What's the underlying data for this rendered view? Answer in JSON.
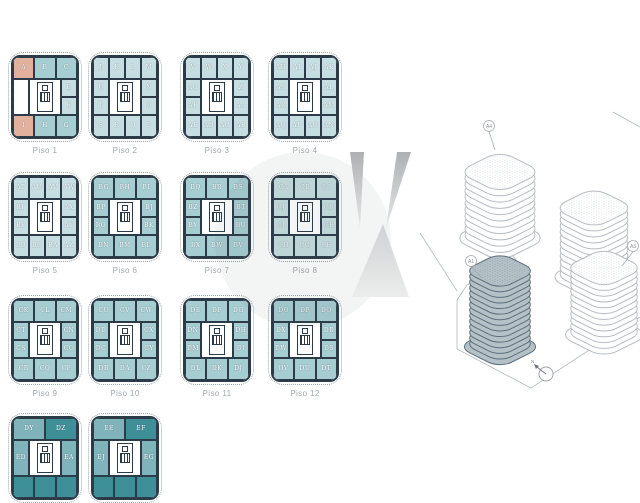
{
  "colors": {
    "white": "#ffffff",
    "salmon": "#e2b19e",
    "pale": "#c6dee1",
    "mid": "#a6cdd2",
    "mid2": "#7fb4bb",
    "dark": "#3e8f98",
    "wall": "#2b3b47",
    "label_gray": "#a0a6ab",
    "site_line": "#b3b8bd",
    "highlight_fill": "#b4c1c7",
    "highlight_stroke": "#5f707b"
  },
  "floors": [
    {
      "label": "Piso 1",
      "top": [
        {
          "t": "A",
          "c": "salmon"
        },
        {
          "t": "B",
          "c": "mid"
        },
        {
          "t": "C",
          "c": "mid"
        }
      ],
      "left": [
        {
          "t": "",
          "c": "white"
        }
      ],
      "right": [
        {
          "t": "E",
          "c": "pale"
        },
        {
          "t": "F",
          "c": "pale"
        }
      ],
      "bottom": [
        {
          "t": "I",
          "c": "salmon"
        },
        {
          "t": "H",
          "c": "mid"
        },
        {
          "t": "G",
          "c": "mid"
        }
      ]
    },
    {
      "label": "Piso 2",
      "top": [
        {
          "t": "J",
          "c": "pale"
        },
        {
          "t": "K",
          "c": "pale"
        },
        {
          "t": "L",
          "c": "pale"
        },
        {
          "t": "M",
          "c": "pale"
        }
      ],
      "left": [
        {
          "t": "U",
          "c": "pale"
        },
        {
          "t": "T",
          "c": "pale"
        }
      ],
      "right": [
        {
          "t": "N",
          "c": "pale"
        },
        {
          "t": "O",
          "c": "pale"
        }
      ],
      "bottom": [
        {
          "t": "S",
          "c": "pale"
        },
        {
          "t": "R",
          "c": "pale"
        },
        {
          "t": "Q",
          "c": "pale"
        },
        {
          "t": "P",
          "c": "pale"
        }
      ]
    },
    {
      "label": "Piso 3",
      "top": [
        {
          "t": "V",
          "c": "pale"
        },
        {
          "t": "W",
          "c": "pale"
        },
        {
          "t": "X",
          "c": "pale"
        },
        {
          "t": "Y",
          "c": "pale"
        }
      ],
      "left": [
        {
          "t": "AG",
          "c": "pale"
        },
        {
          "t": "AF",
          "c": "pale"
        }
      ],
      "right": [
        {
          "t": "Z",
          "c": "pale"
        },
        {
          "t": "AA",
          "c": "pale"
        }
      ],
      "bottom": [
        {
          "t": "AE",
          "c": "pale"
        },
        {
          "t": "AD",
          "c": "pale"
        },
        {
          "t": "AC",
          "c": "pale"
        },
        {
          "t": "AB",
          "c": "pale"
        }
      ]
    },
    {
      "label": "Piso 4",
      "top": [
        {
          "t": "AH",
          "c": "pale"
        },
        {
          "t": "AI",
          "c": "pale"
        },
        {
          "t": "AJ",
          "c": "pale"
        },
        {
          "t": "AK",
          "c": "pale"
        }
      ],
      "left": [
        {
          "t": "AS",
          "c": "pale"
        },
        {
          "t": "AR",
          "c": "pale"
        }
      ],
      "right": [
        {
          "t": "AL",
          "c": "pale"
        },
        {
          "t": "AM",
          "c": "pale"
        }
      ],
      "bottom": [
        {
          "t": "AQ",
          "c": "pale"
        },
        {
          "t": "AP",
          "c": "pale"
        },
        {
          "t": "AO",
          "c": "pale"
        },
        {
          "t": "AN",
          "c": "pale"
        }
      ]
    },
    {
      "label": "Piso 5",
      "top": [
        {
          "t": "AT",
          "c": "pale"
        },
        {
          "t": "AU",
          "c": "pale"
        },
        {
          "t": "AV",
          "c": "pale"
        },
        {
          "t": "AW",
          "c": "pale"
        }
      ],
      "left": [
        {
          "t": "BF",
          "c": "pale"
        },
        {
          "t": "BE",
          "c": "pale"
        }
      ],
      "right": [
        {
          "t": "AX",
          "c": "pale"
        },
        {
          "t": "AY",
          "c": "pale"
        }
      ],
      "bottom": [
        {
          "t": "BD",
          "c": "pale"
        },
        {
          "t": "BC",
          "c": "pale"
        },
        {
          "t": "BA",
          "c": "pale"
        },
        {
          "t": "AZ",
          "c": "pale"
        }
      ]
    },
    {
      "label": "Piso 6",
      "top": [
        {
          "t": "BG",
          "c": "mid"
        },
        {
          "t": "BH",
          "c": "mid"
        },
        {
          "t": "BI",
          "c": "mid"
        }
      ],
      "left": [
        {
          "t": "BP",
          "c": "mid"
        },
        {
          "t": "BO",
          "c": "mid"
        }
      ],
      "right": [
        {
          "t": "BJ",
          "c": "mid"
        },
        {
          "t": "BK",
          "c": "mid"
        }
      ],
      "bottom": [
        {
          "t": "BN",
          "c": "mid"
        },
        {
          "t": "BM",
          "c": "mid"
        },
        {
          "t": "BL",
          "c": "mid"
        }
      ]
    },
    {
      "label": "Piso 7",
      "top": [
        {
          "t": "BQ",
          "c": "mid"
        },
        {
          "t": "BR",
          "c": "mid"
        },
        {
          "t": "BS",
          "c": "mid"
        }
      ],
      "left": [
        {
          "t": "BZ",
          "c": "mid"
        },
        {
          "t": "BY",
          "c": "mid"
        }
      ],
      "right": [
        {
          "t": "BT",
          "c": "mid"
        },
        {
          "t": "BU",
          "c": "mid"
        }
      ],
      "bottom": [
        {
          "t": "BX",
          "c": "mid"
        },
        {
          "t": "BW",
          "c": "mid"
        },
        {
          "t": "BV",
          "c": "mid"
        }
      ]
    },
    {
      "label": "Piso 8",
      "top": [
        {
          "t": "CA",
          "c": "pale"
        },
        {
          "t": "CB",
          "c": "pale"
        },
        {
          "t": "CC",
          "c": "pale"
        }
      ],
      "left": [
        {
          "t": "CJ",
          "c": "pale"
        },
        {
          "t": "CI",
          "c": "pale"
        }
      ],
      "right": [
        {
          "t": "CD",
          "c": "pale"
        },
        {
          "t": "CE",
          "c": "pale"
        }
      ],
      "bottom": [
        {
          "t": "CH",
          "c": "pale"
        },
        {
          "t": "CG",
          "c": "pale"
        },
        {
          "t": "CF",
          "c": "pale"
        }
      ]
    },
    {
      "label": "Piso 9",
      "top": [
        {
          "t": "CK",
          "c": "mid"
        },
        {
          "t": "CL",
          "c": "mid"
        },
        {
          "t": "CM",
          "c": "mid"
        }
      ],
      "left": [
        {
          "t": "CT",
          "c": "mid"
        },
        {
          "t": "CS",
          "c": "mid"
        }
      ],
      "right": [
        {
          "t": "CN",
          "c": "mid"
        },
        {
          "t": "CO",
          "c": "mid"
        }
      ],
      "bottom": [
        {
          "t": "CR",
          "c": "mid"
        },
        {
          "t": "CQ",
          "c": "mid"
        },
        {
          "t": "CP",
          "c": "mid"
        }
      ]
    },
    {
      "label": "Piso 10",
      "top": [
        {
          "t": "CU",
          "c": "mid"
        },
        {
          "t": "CV",
          "c": "mid"
        },
        {
          "t": "CW",
          "c": "mid"
        }
      ],
      "left": [
        {
          "t": "DD",
          "c": "mid"
        },
        {
          "t": "DC",
          "c": "mid"
        }
      ],
      "right": [
        {
          "t": "CX",
          "c": "mid"
        },
        {
          "t": "CY",
          "c": "mid"
        }
      ],
      "bottom": [
        {
          "t": "DB",
          "c": "mid"
        },
        {
          "t": "DA",
          "c": "mid"
        },
        {
          "t": "CZ",
          "c": "mid"
        }
      ]
    },
    {
      "label": "Piso 11",
      "top": [
        {
          "t": "DE",
          "c": "mid"
        },
        {
          "t": "DF",
          "c": "mid"
        },
        {
          "t": "DG",
          "c": "mid"
        }
      ],
      "left": [
        {
          "t": "DN",
          "c": "mid"
        },
        {
          "t": "DM",
          "c": "mid"
        }
      ],
      "right": [
        {
          "t": "DH",
          "c": "mid"
        },
        {
          "t": "DI",
          "c": "mid"
        }
      ],
      "bottom": [
        {
          "t": "DL",
          "c": "mid"
        },
        {
          "t": "DK",
          "c": "mid"
        },
        {
          "t": "DJ",
          "c": "mid"
        }
      ]
    },
    {
      "label": "Piso 12",
      "top": [
        {
          "t": "DO",
          "c": "mid"
        },
        {
          "t": "DP",
          "c": "mid"
        },
        {
          "t": "DQ",
          "c": "mid"
        }
      ],
      "left": [
        {
          "t": "DX",
          "c": "mid"
        },
        {
          "t": "DW",
          "c": "mid"
        }
      ],
      "right": [
        {
          "t": "DR",
          "c": "mid"
        },
        {
          "t": "DS",
          "c": "mid"
        }
      ],
      "bottom": [
        {
          "t": "DV",
          "c": "mid"
        },
        {
          "t": "DU",
          "c": "mid"
        },
        {
          "t": "DT",
          "c": "mid"
        }
      ]
    },
    {
      "label": "",
      "top": [
        {
          "t": "DY",
          "c": "mid2"
        },
        {
          "t": "DZ",
          "c": "dark"
        }
      ],
      "left": [
        {
          "t": "ED",
          "c": "mid2"
        }
      ],
      "right": [
        {
          "t": "EA",
          "c": "mid2"
        }
      ],
      "bottom": [
        {
          "t": "",
          "c": "dark"
        },
        {
          "t": "",
          "c": "dark"
        },
        {
          "t": "",
          "c": "dark"
        }
      ]
    },
    {
      "label": "",
      "top": [
        {
          "t": "EE",
          "c": "mid2"
        },
        {
          "t": "EF",
          "c": "dark"
        }
      ],
      "left": [
        {
          "t": "EJ",
          "c": "mid2"
        }
      ],
      "right": [
        {
          "t": "EG",
          "c": "mid2"
        }
      ],
      "bottom": [
        {
          "t": "",
          "c": "dark"
        },
        {
          "t": "",
          "c": "dark"
        },
        {
          "t": "",
          "c": "dark"
        }
      ]
    }
  ],
  "site": {
    "compass": "N",
    "buildings": [
      {
        "label": "A4",
        "floors": 10,
        "highlight": false
      },
      {
        "label": "",
        "floors": 11,
        "highlight": false
      },
      {
        "label": "A3",
        "floors": 11,
        "highlight": false
      },
      {
        "label": "A1",
        "floors": 13,
        "highlight": true
      }
    ]
  }
}
